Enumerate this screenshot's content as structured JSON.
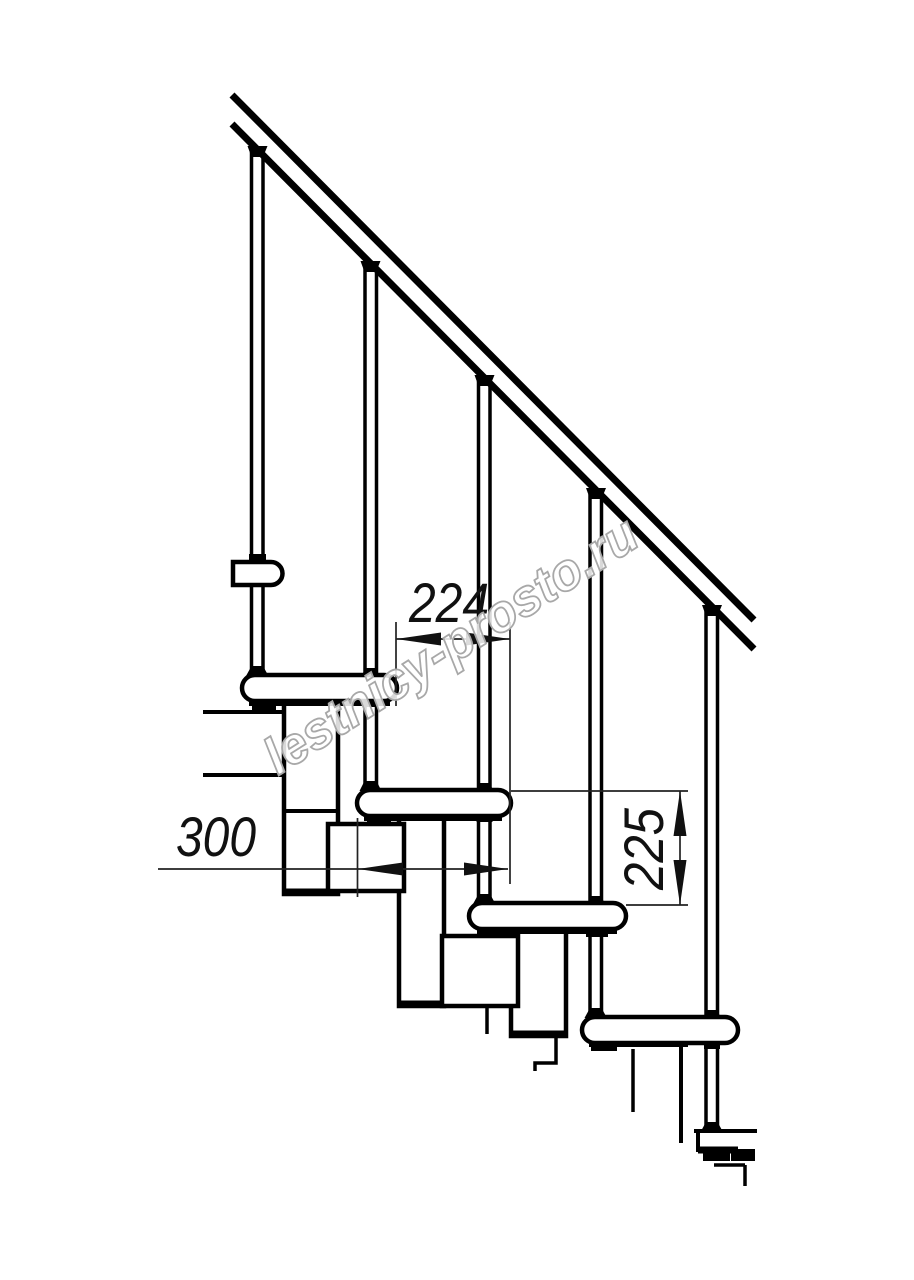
{
  "canvas": {
    "width": 914,
    "height": 1280,
    "background": "#ffffff"
  },
  "drawing": {
    "kind": "modular staircase side elevation line drawing",
    "line_color": "#000000",
    "dimension_line_color": "#222222",
    "dimension_labels": {
      "step_run": "224",
      "tread_depth": "300",
      "step_rise": "225"
    },
    "watermark": {
      "text": "lestnicy-prosto.ru",
      "outline_color": "#a8a8a8",
      "fill_color": "#ffffff"
    }
  }
}
